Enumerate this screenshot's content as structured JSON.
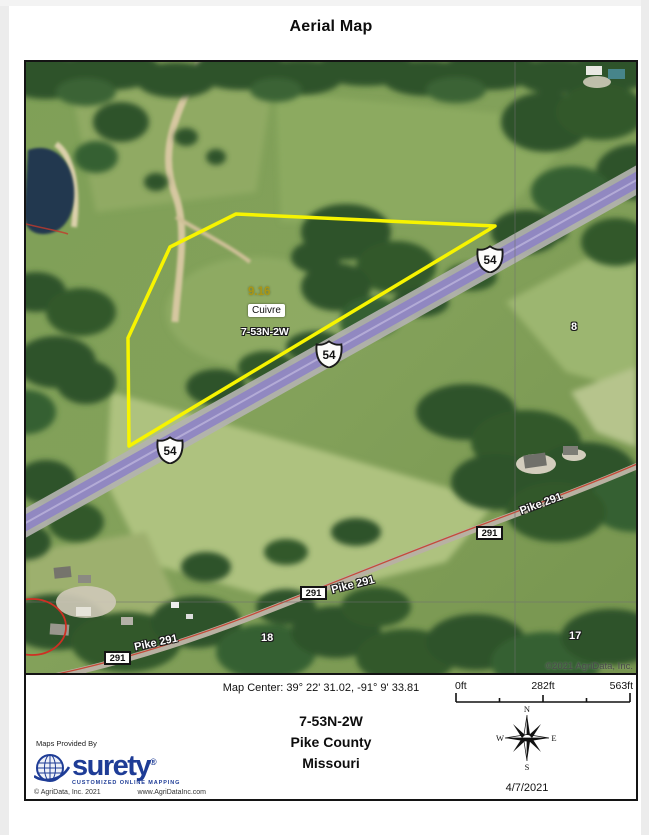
{
  "page": {
    "title": "Aerial Map"
  },
  "map": {
    "parcel": {
      "area": "9.16",
      "name": "Cuivre",
      "township": "7-53N-2W"
    },
    "shields": [
      "54",
      "54",
      "54"
    ],
    "route_boxes": [
      "291",
      "291",
      "291"
    ],
    "road_names": [
      "Pike 291",
      "Pike 291",
      "Pike 291"
    ],
    "section_numbers": [
      "8",
      "18",
      "17"
    ],
    "copyright": "©2021 AgriData, Inc."
  },
  "footer": {
    "map_center": "Map Center: 39° 22' 31.02,  -91° 9' 33.81",
    "scale_labels": [
      "0ft",
      "282ft",
      "563ft"
    ],
    "township": "7-53N-2W",
    "county": "Pike County",
    "state": "Missouri",
    "provided_by": "Maps Provided By",
    "logo_text": "surety",
    "logo_reg": "®",
    "logo_tagline": "CUSTOMIZED ONLINE MAPPING",
    "copyright": "© AgriData, Inc. 2021",
    "website": "www.AgriDataInc.com",
    "date": "4/7/2021",
    "compass": {
      "n": "N",
      "e": "E",
      "s": "S",
      "w": "W"
    }
  },
  "colors": {
    "parcel_outline": "#f7f400",
    "highway_purple": "#8f85c4",
    "road_red": "#c5402e",
    "logo_blue": "#1e3c96",
    "pond_blue": "#233750"
  }
}
